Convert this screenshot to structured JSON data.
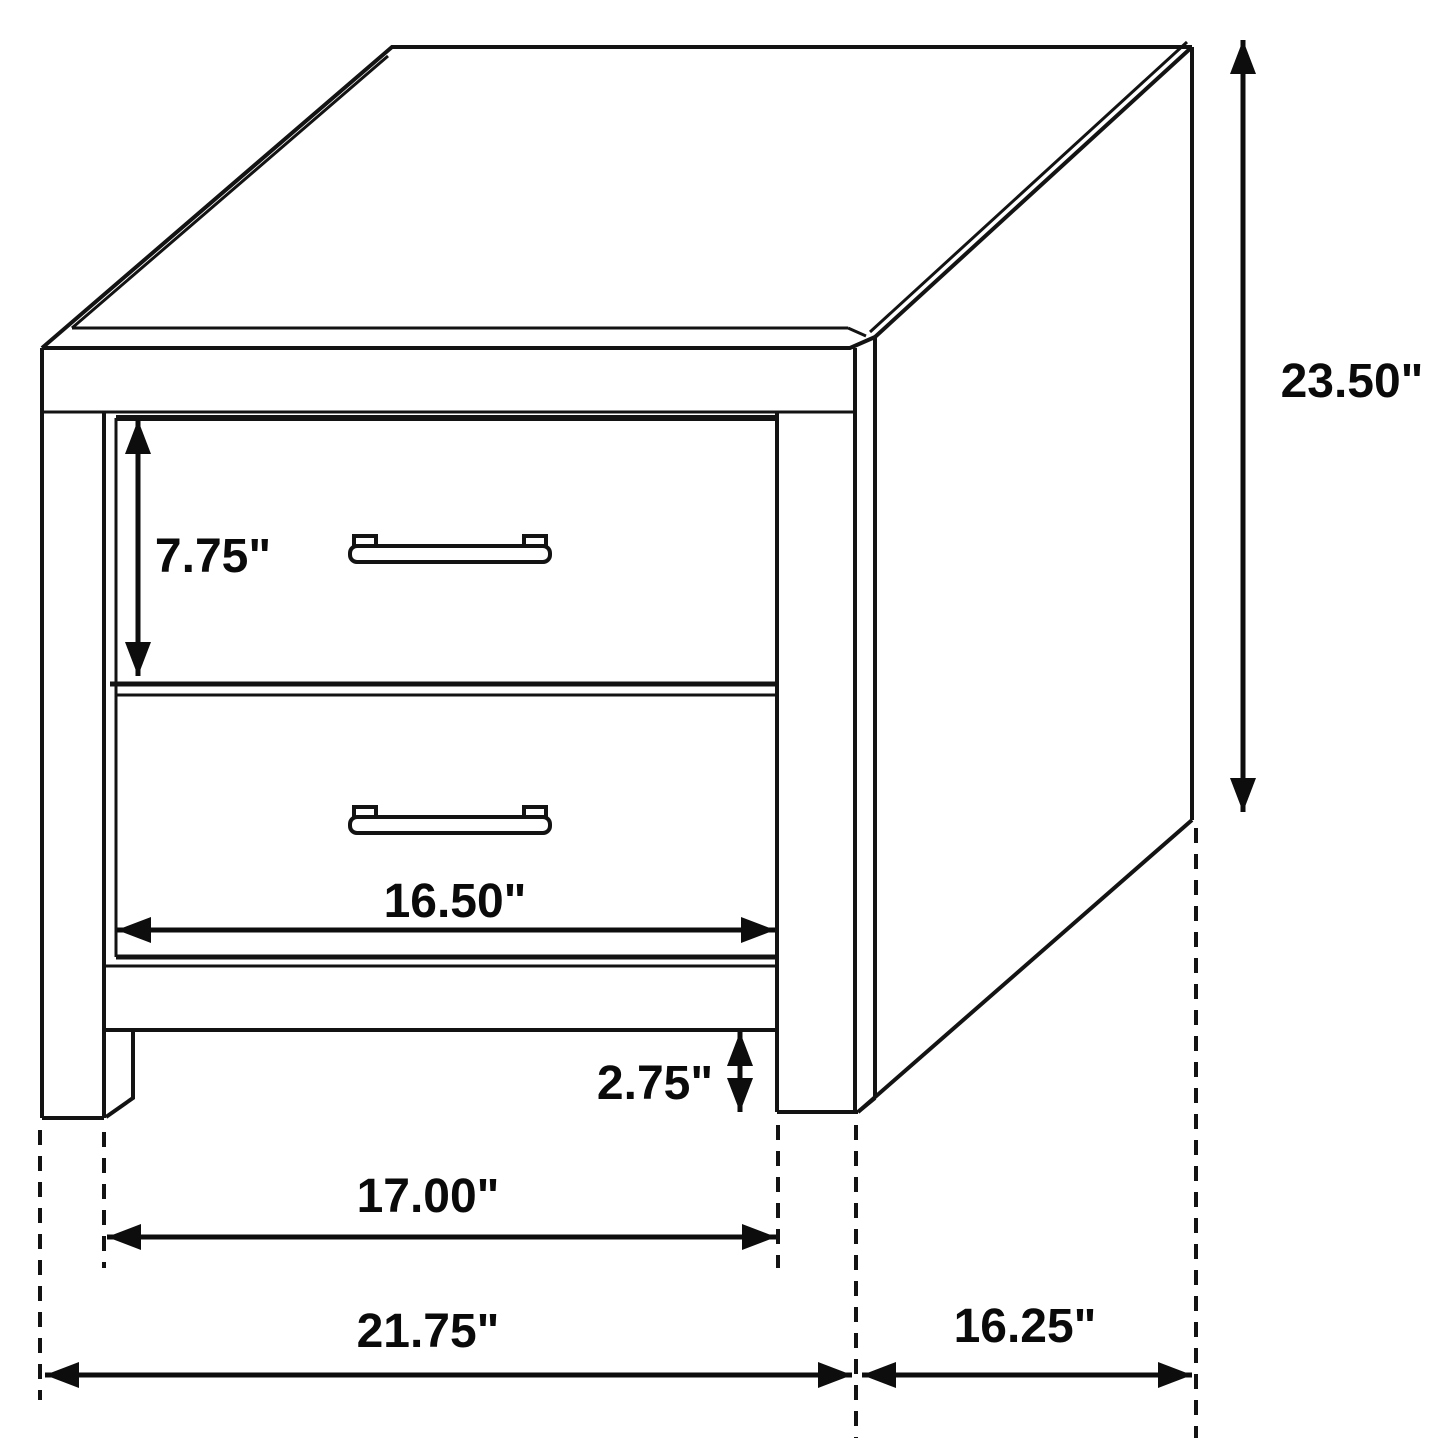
{
  "figure": {
    "type": "furniture-dimension-diagram",
    "subject": "Two-drawer nightstand line drawing in three-quarter perspective with dimension arrows",
    "unit": "inches",
    "ink_color": "#131313",
    "background_color": "#ffffff"
  },
  "dims": {
    "overall_height": {
      "label": "23.50\"",
      "measures": "overall height along right back edge"
    },
    "top_drawer_height": {
      "label": "7.75\"",
      "measures": "top drawer front height"
    },
    "drawer_width": {
      "label": "16.50\"",
      "measures": "drawer front width"
    },
    "foot_height": {
      "label": "2.75\"",
      "measures": "foot height below bottom rail"
    },
    "inner_leg_span": {
      "label": "17.00\"",
      "measures": "inside span between front legs"
    },
    "overall_width": {
      "label": "21.75\"",
      "measures": "overall front width"
    },
    "overall_depth": {
      "label": "16.25\"",
      "measures": "side depth front to back"
    }
  }
}
